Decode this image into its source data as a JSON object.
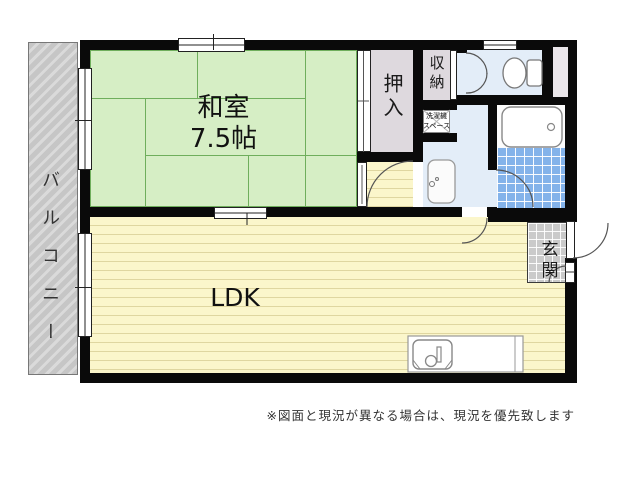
{
  "plan": {
    "rooms": {
      "washitsu": {
        "name": "和室",
        "size": "7.5帖"
      },
      "ldk": {
        "name": "LDK"
      },
      "oshiire": {
        "name": "押入"
      },
      "shuno": {
        "name": "収納"
      },
      "sentakuki": {
        "line1": "洗濯機",
        "line2": "スペース"
      },
      "genkan": {
        "name": "玄関"
      },
      "balcony": {
        "name": "バルコニー"
      }
    },
    "note": "※図面と現況が異なる場合は、現況を優先致します",
    "colors": {
      "wall": "#0a0a0a",
      "tatami": "#d6eec5",
      "tatami-line": "#6fae5c",
      "floor": "#fbf6cb",
      "wet": "#e3edf8",
      "tile": "#84b3ea",
      "closet": "#ded9de",
      "balcony": "#cbcbcb"
    }
  }
}
